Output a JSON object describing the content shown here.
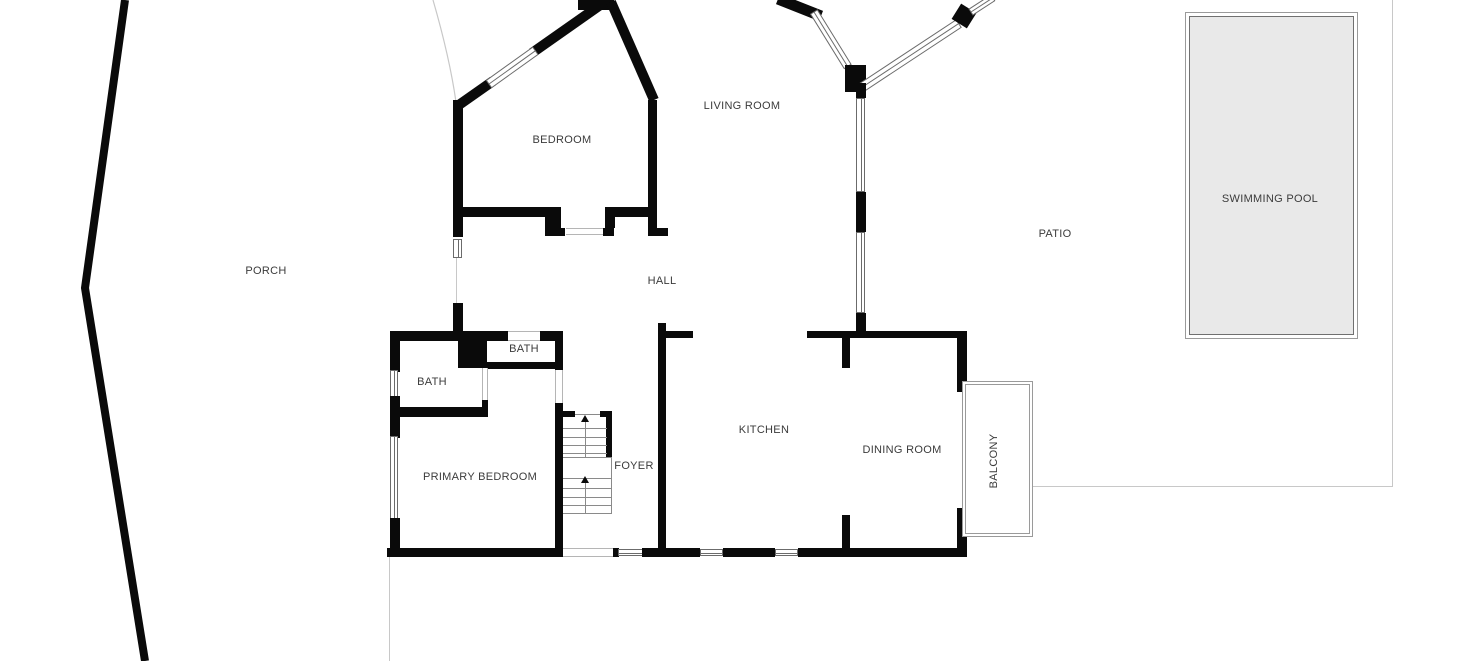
{
  "labels": {
    "porch": "PORCH",
    "bedroom": "BEDROOM",
    "living_room": "LIVING ROOM",
    "hall": "HALL",
    "bath_upper": "BATH",
    "bath_left": "BATH",
    "primary_bedroom": "PRIMARY BEDROOM",
    "foyer": "FOYER",
    "kitchen": "KITCHEN",
    "dining_room": "DINING ROOM",
    "balcony": "BALCONY",
    "patio": "PATIO",
    "swimming_pool": "SWIMMING POOL"
  },
  "colors": {
    "wall": "#0a0a0a",
    "window_frame": "#6b6b6b",
    "door_line": "#b5b5b5",
    "thin_line": "#c8c8c8",
    "stair_line": "#8a8a8a",
    "pool_fill": "#e9e9e9",
    "pool_border": "#707070",
    "outline_border": "#9a9a9a",
    "text": "#3b3b3b",
    "background": "#ffffff"
  }
}
